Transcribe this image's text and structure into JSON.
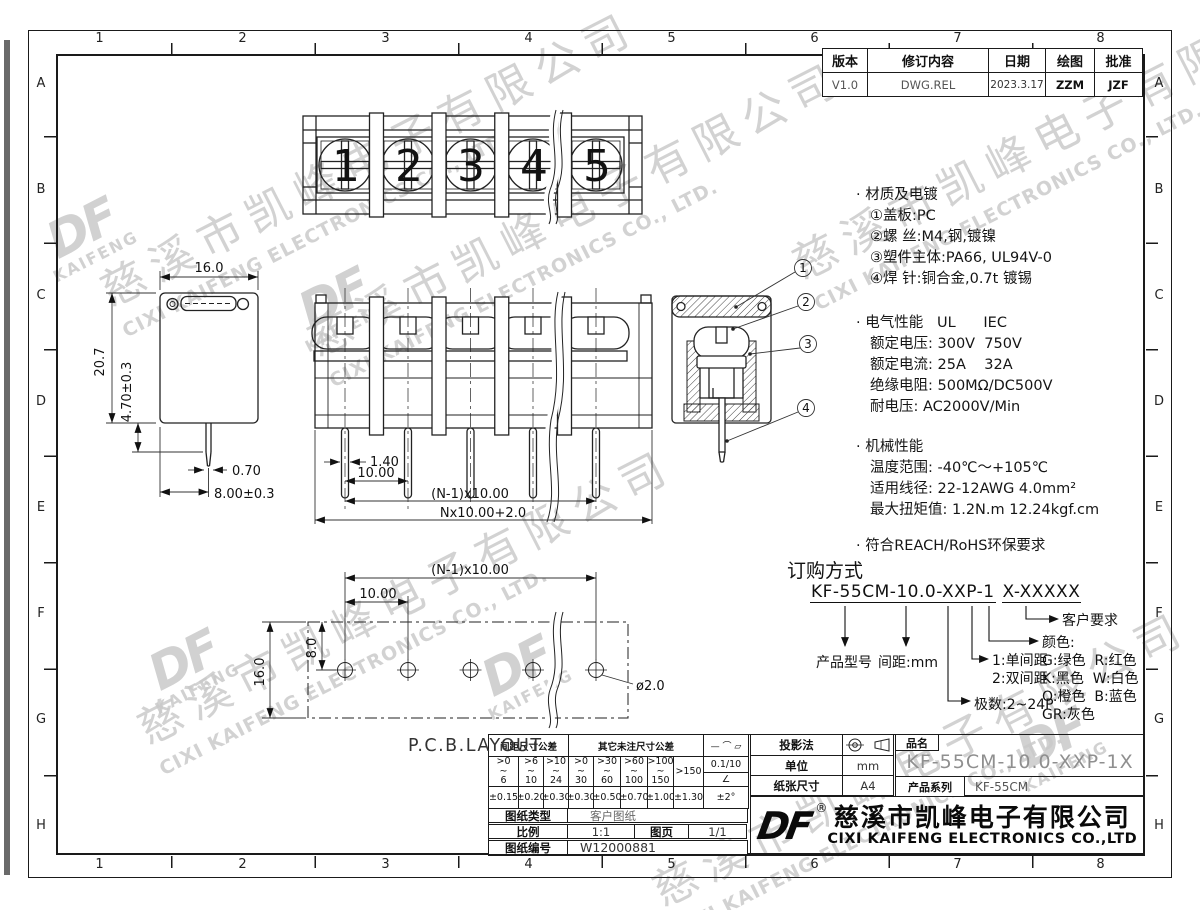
{
  "frame": {
    "cols": [
      "1",
      "2",
      "3",
      "4",
      "5",
      "6",
      "7",
      "8"
    ],
    "rows": [
      "A",
      "B",
      "C",
      "D",
      "E",
      "F",
      "G",
      "H"
    ]
  },
  "revision": {
    "headers": [
      "版本",
      "修订内容",
      "日期",
      "绘图",
      "批准"
    ],
    "values": [
      "V1.0",
      "DWG.REL",
      "2023.3.17",
      "ZZM",
      "JZF"
    ]
  },
  "watermark": {
    "company_cn": "慈溪市凯峰电子有限公司",
    "company_en": "CIXI KAIFENG ELECTRONICS CO., LTD.",
    "logo": "DF",
    "logo_sub": "KAIFENG"
  },
  "views": {
    "top": {
      "screw_numbers": [
        "1",
        "2",
        "3",
        "4",
        "5"
      ]
    },
    "side": {
      "dim_width": "16.0",
      "dim_height": "20.7",
      "dim_pin_len": "4.70±0.3",
      "dim_pin_w": "0.70",
      "dim_pin_off": "8.00±0.3"
    },
    "front": {
      "dim_pin_w": "1.40",
      "dim_pitch": "10.00",
      "dim_span": "(N-1)x10.00",
      "dim_total": "Nx10.00+2.0"
    },
    "section": {
      "callouts": [
        "1",
        "2",
        "3",
        "4"
      ]
    },
    "pcb": {
      "label": "P.C.B.LAYOUT",
      "dim_span": "(N-1)x10.00",
      "dim_pitch": "10.00",
      "dim_row": "8.0",
      "dim_height": "16.0",
      "dim_hole": "ø2.0"
    }
  },
  "specs": {
    "material": {
      "title": "· 材质及电镀",
      "items": [
        "①盖板:PC",
        "②螺 丝:M4,钢,镀镍",
        "③塑件主体:PA66, UL94V-0",
        "④焊 针:铜合金,0.7t 镀锡"
      ]
    },
    "electrical": {
      "title": "· 电气性能   UL      IEC",
      "items": [
        "额定电压: 300V  750V",
        "额定电流: 25A    32A",
        "绝缘电阻: 500MΩ/DC500V",
        "耐电压: AC2000V/Min"
      ]
    },
    "mechanical": {
      "title": "· 机械性能",
      "items": [
        "温度范围: -40℃～+105℃",
        "适用线径: 22-12AWG 4.0mm²",
        "最大扭矩值: 1.2N.m 12.24kgf.cm"
      ]
    },
    "compliance": {
      "title": "· 符合REACH/RoHS环保要求"
    }
  },
  "ordering": {
    "title": "订购方式",
    "code_main": "KF-55CM-10.0-XXP-1",
    "code_suffix": "X-XXXXX",
    "label_model": "产品型号",
    "label_pitch": "间距:mm",
    "label_poles": "极数:2~24P",
    "label_single": "1:单间距",
    "label_double": "2:双间距",
    "label_color": "颜色:",
    "colors": [
      "G:绿色  R:红色",
      "K:黑色  W:白色",
      "O:橙色  B:蓝色",
      "GR:灰色"
    ],
    "label_custom": "客户要求"
  },
  "title_block": {
    "pitch_tol_header": "间距尺寸公差",
    "other_tol_header": "其它未注尺寸公差",
    "geo_symbols": "—  ⌒  ▱",
    "tilde": "~",
    "ranges_top": [
      ">0",
      ">6",
      ">10",
      ">0",
      ">30",
      ">60",
      ">100"
    ],
    "ranges_bottom": [
      "6",
      "10",
      "24",
      "30",
      "60",
      "100",
      "150"
    ],
    "range_over": ">150",
    "flatness_value": "0.1/10",
    "angle_symbol": "∠",
    "angle_tol": "±2°",
    "tol_values": [
      "±0.15",
      "±0.20",
      "±0.30",
      "±0.30",
      "±0.50",
      "±0.70",
      "±1.00",
      "±1.30"
    ],
    "projection_label": "投影法",
    "unit_label": "单位",
    "unit_value": "mm",
    "paper_label": "纸张尺寸",
    "paper_value": "A4",
    "name_label": "品名",
    "name_value": "KF-55CM-10.0-XXP-1X",
    "series_label": "产品系列",
    "series_value": "KF-55CM",
    "type_label": "图纸类型",
    "type_value": "客户图纸",
    "scale_label": "比例",
    "scale_value": "1:1",
    "sheet_label": "图页",
    "sheet_value": "1/1",
    "number_label": "图纸编号",
    "number_value": "W12000881",
    "reg": "®",
    "logo": "DF",
    "company_cn": "慈溪市凯峰电子有限公司",
    "company_en": "CIXI KAIFENG ELECTRONICS CO.,LTD"
  }
}
